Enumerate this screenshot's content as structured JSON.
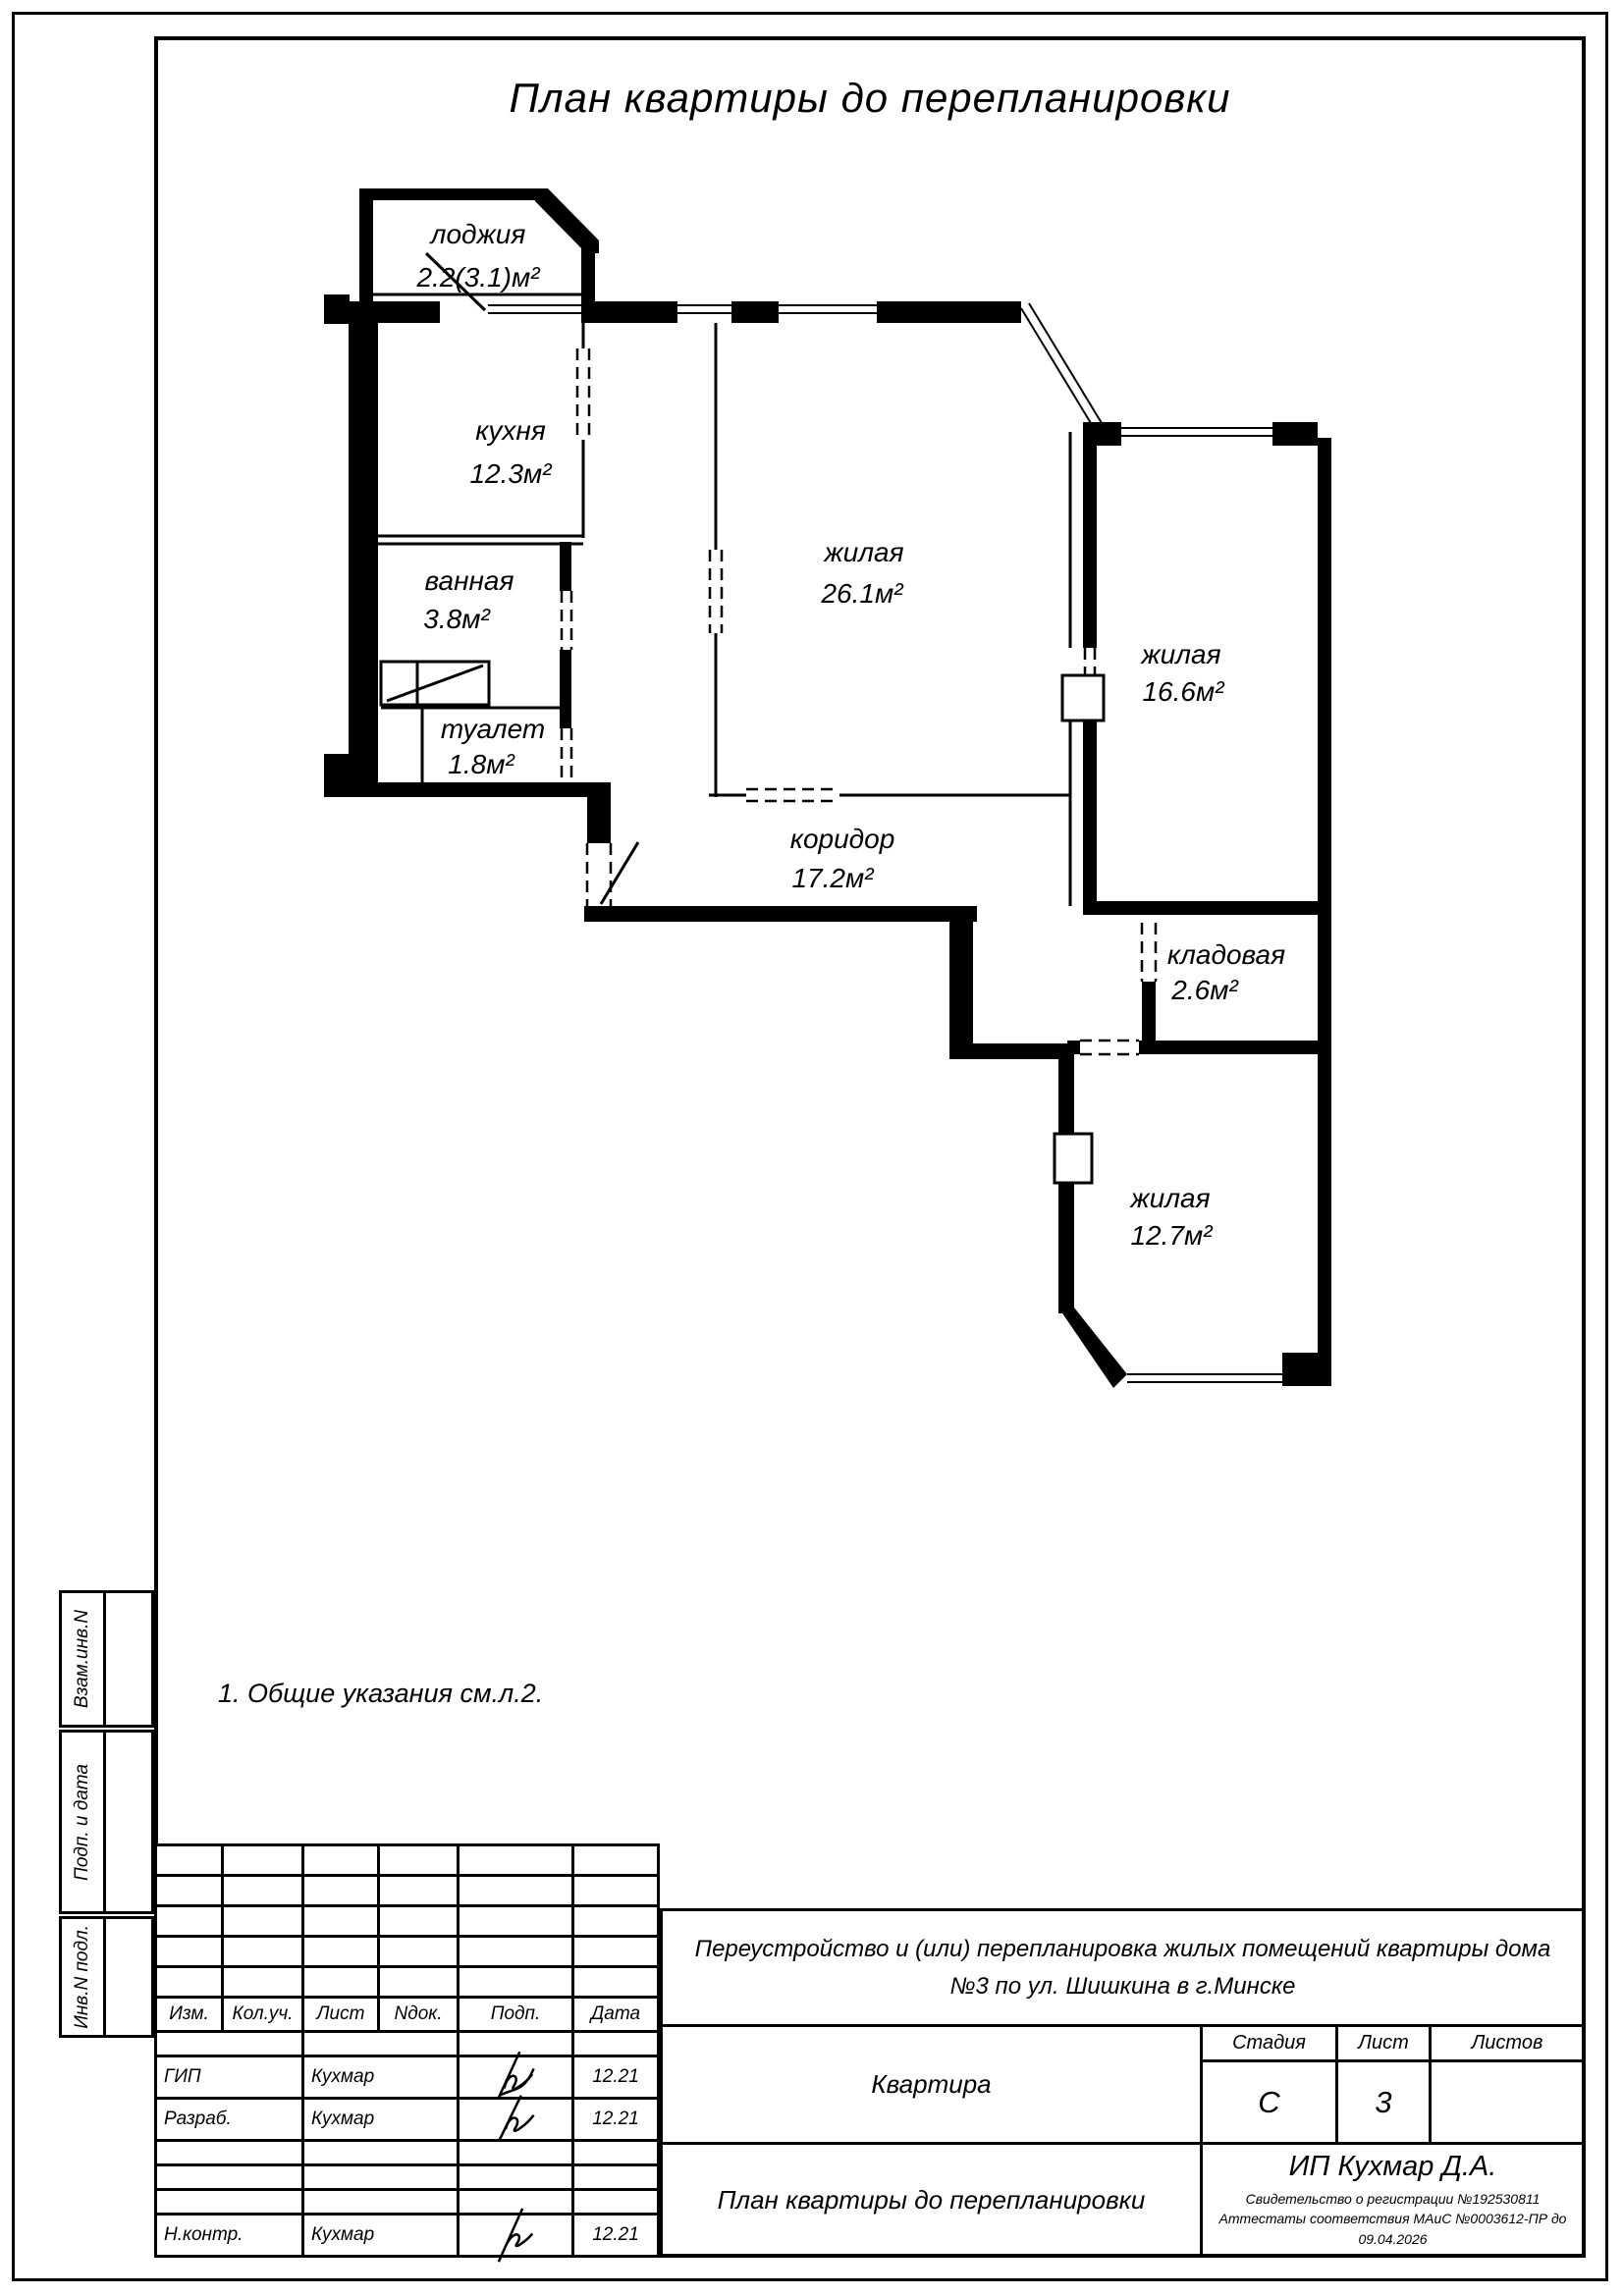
{
  "page_title": "План квартиры до перепланировки",
  "note": "1. Общие указания см.л.2.",
  "rooms": [
    {
      "name": "лоджия",
      "area": "2.2(3.1)м²"
    },
    {
      "name": "кухня",
      "area": "12.3м²"
    },
    {
      "name": "ванная",
      "area": "3.8м²"
    },
    {
      "name": "туалет",
      "area": "1.8м²"
    },
    {
      "name": "жилая",
      "area": "26.1м²"
    },
    {
      "name": "жилая",
      "area": "16.6м²"
    },
    {
      "name": "коридор",
      "area": "17.2м²"
    },
    {
      "name": "кладовая",
      "area": "2.6м²"
    },
    {
      "name": "жилая",
      "area": "12.7м²"
    }
  ],
  "sidebar": {
    "labels": [
      "Взам.инв.N",
      "Подп. и дата",
      "Инв.N подл."
    ]
  },
  "title_block": {
    "revision_headers": [
      "Изм.",
      "Кол.уч.",
      "Лист",
      "Nдок.",
      "Подп.",
      "Дата"
    ],
    "staff": [
      {
        "role": "ГИП",
        "name": "Кухмар",
        "date": "12.21"
      },
      {
        "role": "Разраб.",
        "name": "Кухмар",
        "date": "12.21"
      },
      {
        "role": "Н.контр.",
        "name": "Кухмар",
        "date": "12.21"
      }
    ],
    "project_line1": "Переустройство и (или) перепланировка жилых помещений квартиры дома",
    "project_line2": "№3 по ул. Шишкина в г.Минске",
    "object_name": "Квартира",
    "stage_label": "Стадия",
    "sheet_label": "Лист",
    "sheets_label": "Листов",
    "stage_value": "С",
    "sheet_value": "3",
    "sheets_value": "",
    "sheet_title": "План квартиры до перепланировки",
    "company": "ИП Кухмар Д.А.",
    "cert_line1": "Свидетельство о регистрации №192530811",
    "cert_line2": "Аттестаты соответствия МАиС №0003612-ПР до 09.04.2026"
  },
  "colors": {
    "ink": "#000000",
    "paper": "#ffffff"
  }
}
